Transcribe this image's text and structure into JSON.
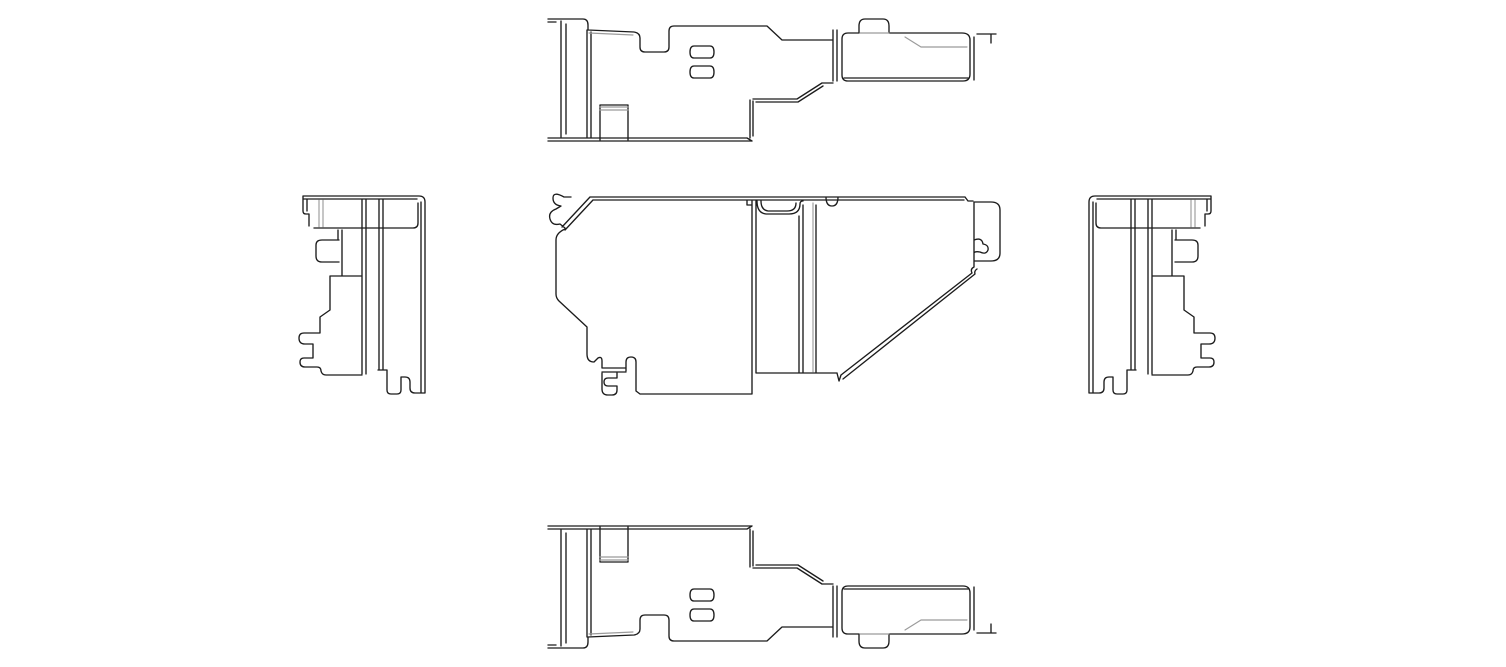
{
  "canvas": {
    "width": 1506,
    "height": 667,
    "background_color": "#ffffff",
    "line_color": "#1c1c1c",
    "hidden_line_color": "#9b9b9b"
  },
  "drawing": {
    "kind": "orthographic-multiview-technical-drawing",
    "subject": "sheet-metal-bracket",
    "views": {
      "top": {
        "label": "top-view",
        "black": "M548,19 H559 M548,22 H556 M556,19 H583 Q588,19 588,25 V30 M561,21 V137 M566,24 V134 M587,30 V138 M591,32 V138 M588,30 L634,32 Q640,33 640,38 V47 Q640,52 645,52 H664 Q669,52 669,47 V31 Q669,26 674,26 H767 L782,40 H833 M833,30 V81 M837,30 V81 M842,75 V39 Q842,33 848,33 H859 V26 Q859,19 865,19 H883 Q889,19 889,26 V33 H962 Q970,33 970,40 V74 Q970,81 963,81 H848 Q842,81 842,75 M844,78 H968 M974,37 V80 M977,34 H996 M991,34 V43 M750,100 V138 M753,101 V136 M753,99 H797 L822,83 M756,102 H798 L823,86 M822,83 H833 M548,138 H747 M548,141 H752 M747,138 L752,141 M600,105 H628 V140 M600,105 V140 M694,46 H710 Q714,46 714,52 Q714,58 710,58 H694 Q690,58 690,52 Q690,46 694,46 M694,66 H710 Q714,66 714,72 Q714,78 710,78 H694 Q690,78 690,72 Q690,66 694,66",
        "gray": "M600,107 H628 M600,110 H628 M905,37 L921,47 H967 M860,33 H889 M589,33 L633,35"
      },
      "front": {
        "label": "front-view",
        "black": "M590,197 H965 M593,200 H964 M571,197 H564 Q553,191 553,198 Q553,205 561,206 L556,209 Q548,212 550,219 Q552,226 560,224 L565,228 M590,197 L562,227 M593,200 L565,230 M565,229 Q556,233 556,240 V294 Q556,298 559,301 L587,327 V354 M587,354 Q587,362 594,362 L598,358 Q602,356 602,361 V368 M602,368 H626 M602,372 H626 M602,373 V389 Q602,395 608,395 H612 Q617,395 617,390 V386 H608 Q604,386 604,382 Q604,378 608,378 H617 V373 M626,371 V362 Q626,357 631,357 Q636,357 636,362 V391 L640,394 M640,394 H752 M757,373 H837 M752,201 V394 M756,201 V373 M747,200 V205 L752,205 M799,216 V373 M803,205 V373 M816,205 V373 M757,201 Q757,213 766,214 H789 Q800,214 800,204 Q800,201 803,201 M761,201 Q761,210 768,211 H787 Q796,211 796,203 M826,197 Q826,206 832,206 Q838,206 838,197 M965,197 L968,201 H973 M974,202 V267 M974,202 H991 Q1000,202 1000,210 V253 Q1000,261 991,261 H974 M974,240 Q982,237 983,244 Q989,245 988,250 Q986,255 980,252 Q975,251 974,253 M974,267 Q970,269 972,273 L841,375 M977,269 Q974,271 975,274 L843,379 M841,375 L839,381 L837,373",
        "gray": "M813,203 V372"
      },
      "left": {
        "label": "left-side-view",
        "black": "M303,196 H419 Q425,196 425,202 V393 M303,199 H417 M421,202 V393 M314,228 H413 Q418,228 418,223 V203 M303,196 V211 Q303,214 306,214 H309 V226 M307,199 V211 M362,199 V374 M366,199 V374 M379,199 V370 M383,199 V370 M338,230 V240 M342,230 V276 M339,240 H322 Q316,240 316,245 V256 Q316,262 322,262 H339 M330,276 H362 M330,276 V310 L320,317 V333 H304 Q299,333 299,338 Q299,344 305,344 H313 V358 H304 Q300,358 300,362 Q300,367 305,367 H317 Q321,367 321,371 Q322,375 326,375 H362 M378,370 H387 M387,370 V390 Q387,394 391,394 H397 Q401,394 401,390 V377 H405 Q410,377 410,382 V388 Q410,393 415,393 H425",
        "gray": "M319,200 V227 M323,200 V227"
      },
      "bottom": {
        "label": "bottom-view",
        "mirror_of": "top",
        "transform": "translate(0,667) scale(1,-1)"
      },
      "right": {
        "label": "right-side-view",
        "mirror_of": "left",
        "transform": "translate(1514,0) scale(-1,1)"
      }
    }
  }
}
